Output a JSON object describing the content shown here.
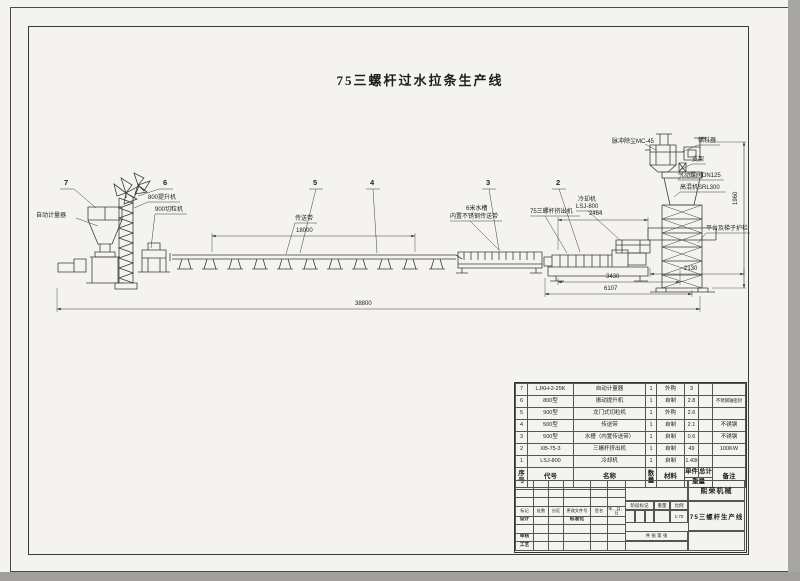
{
  "title": "75三螺杆过水拉条生产线",
  "labels": {
    "auto_meter": "自动计量器",
    "elevator": "800提升机",
    "pelletizer": "900切粒机",
    "conveyor": "传送带",
    "tank_line1": "6米水槽",
    "tank_line2": "内置不锈钢传送带",
    "extruder": "75三螺杆挤出机",
    "cooler_line1": "冷却机",
    "cooler_line2": "LSJ-800",
    "dust_collector": "脉冲除尘MC-45",
    "silo": "储料器",
    "support_frame": "支架",
    "valve": "气动蝶阀DN125",
    "mixer": "高混机SRL300",
    "platform": "平台及梯子护栏"
  },
  "balloons": [
    "7",
    "6",
    "5",
    "4",
    "3",
    "2"
  ],
  "dimensions": {
    "conveyor_length": "18000",
    "extruder_length": "2464",
    "base_a": "3430",
    "base_b": "6107",
    "tower_width": "2130",
    "tower_height": "1960",
    "overall_length": "38800"
  },
  "parts": {
    "headers": {
      "no": "序号",
      "code": "代号",
      "name": "名称",
      "qty": "数量",
      "material": "材料",
      "unit": "单件",
      "total": "总计",
      "weight": "重量",
      "remark": "备注"
    },
    "rows": [
      {
        "no": "7",
        "code": "LJKH-2-25K",
        "name": "自动计量器",
        "qty": "1",
        "material": "外购",
        "unit_weight": "3",
        "total_weight": "",
        "remark": ""
      },
      {
        "no": "6",
        "code": "800型",
        "name": "振动提升机",
        "qty": "1",
        "material": "自制",
        "unit_weight": "2.8",
        "total_weight": "",
        "remark": "不锈钢轴密封"
      },
      {
        "no": "5",
        "code": "900型",
        "name": "龙门式切粒机",
        "qty": "1",
        "material": "外购",
        "unit_weight": "2.6",
        "total_weight": "",
        "remark": ""
      },
      {
        "no": "4",
        "code": "500型",
        "name": "传送带",
        "qty": "1",
        "material": "自制",
        "unit_weight": "2.1",
        "total_weight": "",
        "remark": "不锈钢"
      },
      {
        "no": "3",
        "code": "500型",
        "name": "水槽（内置传送带）",
        "qty": "1",
        "material": "自制",
        "unit_weight": "0.6",
        "total_weight": "",
        "remark": "不锈钢"
      },
      {
        "no": "2",
        "code": "XB-75-3",
        "name": "三螺杆挤出机",
        "qty": "1",
        "material": "自制",
        "unit_weight": "49",
        "total_weight": "",
        "remark": "100KW"
      },
      {
        "no": "1",
        "code": "LSJ-800",
        "name": "冷却机",
        "qty": "1",
        "material": "自制",
        "unit_weight": "1.43t",
        "total_weight": "",
        "remark": ""
      }
    ]
  },
  "title_block": {
    "company": "熙荣机械",
    "product": "75三螺杆生产线",
    "rev_headers": [
      "标记",
      "处数",
      "分区",
      "更改文件号",
      "签名",
      "年、月、日"
    ],
    "design": "设计",
    "standard": "标准化",
    "check": "审核",
    "craft": "工艺",
    "stage": "阶段标记",
    "weight": "重量",
    "scale": "比例",
    "scale_value": "1:70",
    "sheet": "共  张  第  张"
  }
}
